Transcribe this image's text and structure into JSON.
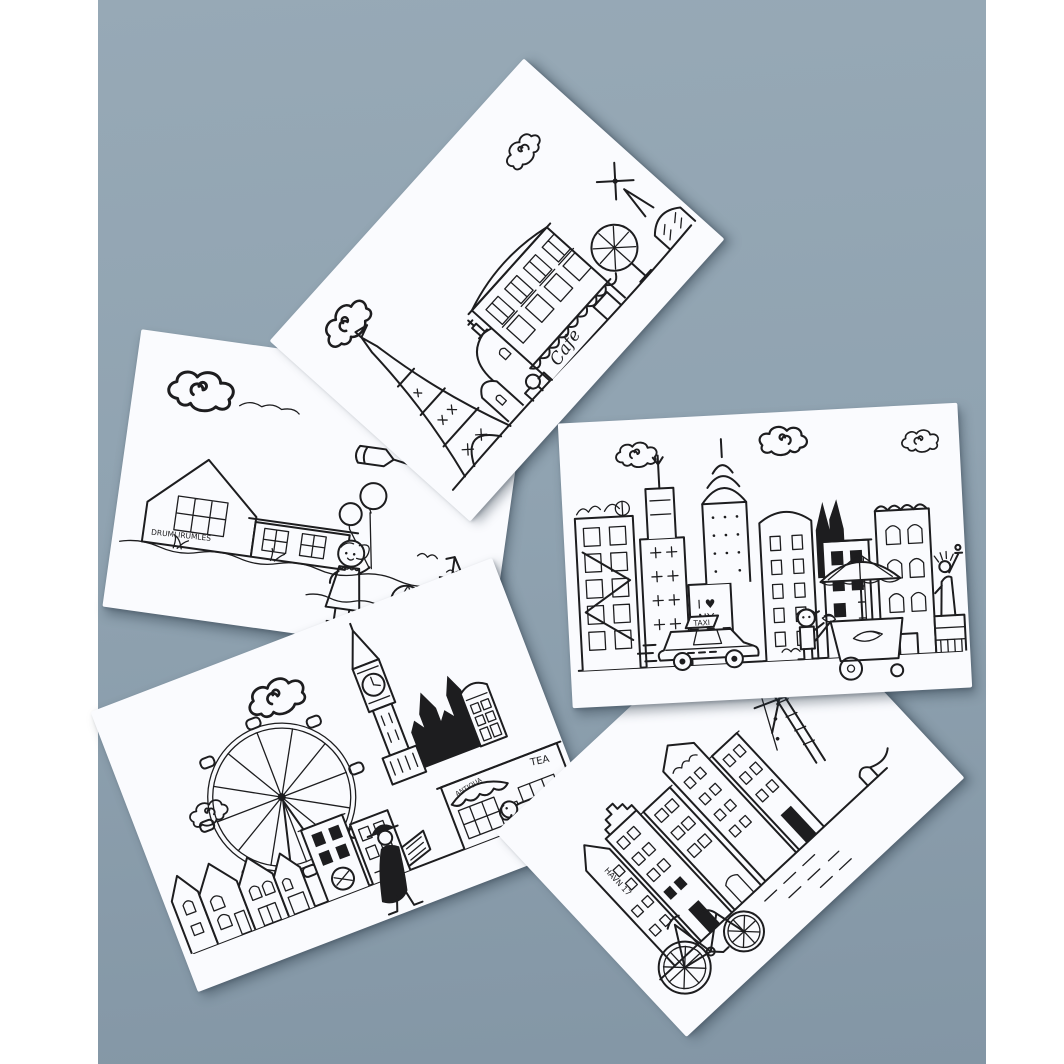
{
  "scene": {
    "type": "photograph",
    "description": "Five black-and-white hand-drawn city illustration postcards scattered on a blue-grey surface, with white vertical borders at left and right",
    "card_count": 5,
    "colors": {
      "surface": "#90a3b1",
      "frame": "#ffffff",
      "card": "#fafbfe",
      "ink": "#1d1d1f"
    }
  },
  "cards": [
    {
      "id": "paris",
      "subject": "Paris street scene: Eiffel Tower, Sacre-Coeur dome, Haussmann facade with cafe awning, pollarded tree, stone arch, windmill, curly clouds",
      "texts": {
        "cafe_sign": "Cafe"
      }
    },
    {
      "id": "seaside",
      "subject": "Seaside scene: long summer house with lattice windows, girl holding two balloons, beach ball, dune grass, gulls, sailboat, airplane towing a banner, curly cloud",
      "texts": {
        "house_sign": "DRUMLIRUMLES"
      }
    },
    {
      "id": "new-york",
      "subject": "New York scene: Empire State Building, Chrysler Building, brownstones with fire escapes, Statue of Liberty, checker taxi, hot-dog cart with umbrella and vendor, clouds",
      "texts": {
        "graffiti_top": "I ♥",
        "graffiti_bottom": "NY",
        "taxi_sign": "TAXI"
      }
    },
    {
      "id": "london",
      "subject": "London scene: Big Ben, dark Parliament spires, telephone box, London Eye ferris wheel, gabled row houses, tea shop with awning, gentleman in bowler hat reading a newspaper, dachshund",
      "texts": {
        "awning_sign": "ANTIQUA",
        "tea_sign": "TEA"
      }
    },
    {
      "id": "copenhagen",
      "subject": "Copenhagen Nyhavn scene: tall gabled canal houses, large bicycle, ship mast with rigging, quay bollard with rope, curly cloud",
      "texts": {
        "house_sign": "HAVN 17"
      }
    }
  ]
}
